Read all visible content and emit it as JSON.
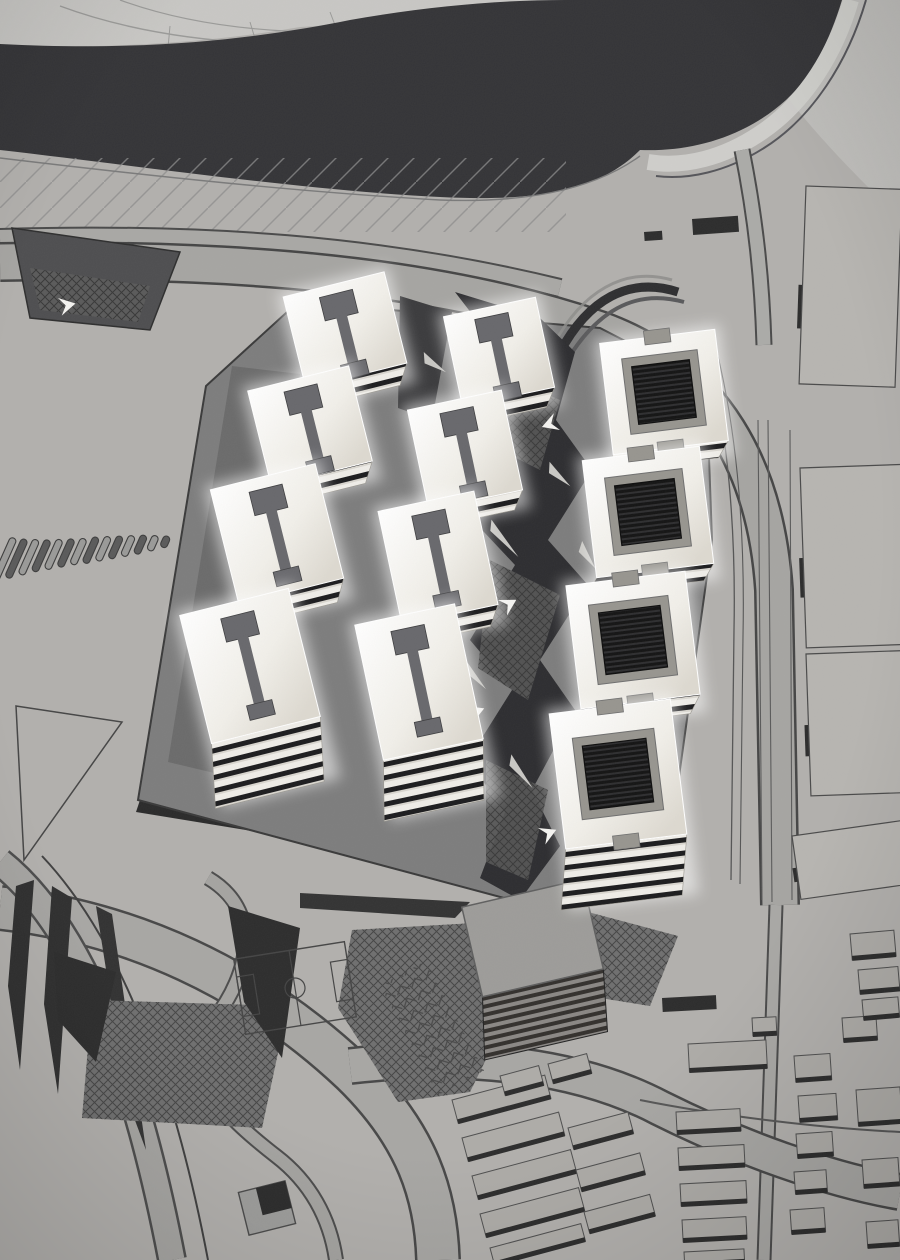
{
  "image": {
    "type": "photograph",
    "subject": "monochrome architectural scale model of a riverside masterplan",
    "description": "Cardboard site model with three rows of illuminated translucent apartment blocks on a dark podium, angular dark plaza, engraved football pitch, stacked cardboard pavilion, surrounding streets and low cardboard housing blocks, dark river across the top"
  },
  "palette": {
    "board": "#b2b0ad",
    "boardLight": "#c8c7c4",
    "river": "#343437",
    "podium": "#7d7d7d",
    "podiumInner": "#6b6b6b",
    "podiumEdge": "#3a3a3a",
    "plazaDark": "#2d2d30",
    "roofBar": "#68686c",
    "courtFrame": "#97958f",
    "cardDark": "#2c2c2c",
    "roadLight": "#a8a7a4",
    "lineDark": "#4a4a4a",
    "white": "#f4f3f0",
    "arrowGray": "#c9c8c4",
    "slabTop": "#aeaca8",
    "blockTop": "#b7b5b1"
  },
  "model": {
    "tower_rows": 3,
    "towers_total": 12,
    "courtyard_blocks": 4,
    "ibeam_blocks": 8,
    "football_pitch": 1,
    "stacked_pavilion": 1
  },
  "builder": {
    "towers": {
      "rows": [
        {
          "name": "west-row",
          "kind": "ibeam",
          "angle": -14,
          "items": [
            {
              "cx": 345,
              "cy": 330,
              "w": 104,
              "h": 94,
              "side": 20
            },
            {
              "cx": 310,
              "cy": 426,
              "w": 104,
              "h": 98,
              "side": 20
            },
            {
              "cx": 277,
              "cy": 534,
              "w": 108,
              "h": 118,
              "side": 22
            },
            {
              "cx": 250,
              "cy": 666,
              "w": 112,
              "h": 132,
              "side": 64
            }
          ]
        },
        {
          "name": "center-row",
          "kind": "ibeam",
          "angle": -12,
          "items": [
            {
              "cx": 499,
              "cy": 352,
              "w": 94,
              "h": 92,
              "side": 18
            },
            {
              "cx": 465,
              "cy": 450,
              "w": 96,
              "h": 102,
              "side": 18
            },
            {
              "cx": 438,
              "cy": 558,
              "w": 98,
              "h": 116,
              "side": 20
            },
            {
              "cx": 419,
              "cy": 682,
              "w": 102,
              "h": 138,
              "side": 60
            }
          ]
        },
        {
          "name": "east-row",
          "kind": "court",
          "angle": -7,
          "items": [
            {
              "cx": 664,
              "cy": 392,
              "w": 116,
              "h": 112,
              "side": 16
            },
            {
              "cx": 648,
              "cy": 512,
              "w": 118,
              "h": 118,
              "side": 16
            },
            {
              "cx": 633,
              "cy": 640,
              "w": 120,
              "h": 124,
              "side": 18
            },
            {
              "cx": 618,
              "cy": 774,
              "w": 122,
              "h": 136,
              "side": 60
            }
          ]
        }
      ]
    },
    "slots": {
      "startX": 4,
      "startY": 560,
      "dx": 12.4,
      "dy": -1.4,
      "rot": 24,
      "width": 7,
      "lengths": [
        48,
        42,
        38,
        34,
        32,
        30,
        28,
        28,
        26,
        24,
        22,
        20,
        16,
        12
      ]
    },
    "chevrons": [
      {
        "x": 490,
        "y": 336,
        "r": -20
      },
      {
        "x": 446,
        "y": 430,
        "r": -28
      },
      {
        "x": 498,
        "y": 600,
        "r": -30
      },
      {
        "x": 466,
        "y": 706,
        "r": -22
      },
      {
        "x": 436,
        "y": 926,
        "r": -16
      },
      {
        "x": 244,
        "y": 1050,
        "r": -38
      },
      {
        "x": 58,
        "y": 298,
        "r": -12
      },
      {
        "x": 560,
        "y": 430,
        "r": 160
      },
      {
        "x": 538,
        "y": 828,
        "r": -24
      }
    ],
    "arrows": [
      {
        "x": 494,
        "y": 518,
        "r": 58,
        "l": 46
      },
      {
        "x": 514,
        "y": 753,
        "r": 62,
        "l": 40
      },
      {
        "x": 552,
        "y": 460,
        "r": 55,
        "l": 32
      },
      {
        "x": 468,
        "y": 658,
        "r": 60,
        "l": 36
      },
      {
        "x": 426,
        "y": 350,
        "r": 48,
        "l": 30
      },
      {
        "x": 585,
        "y": 540,
        "r": 70,
        "l": 30
      }
    ],
    "bigBlocks": [
      {
        "x": 806,
        "y": 186,
        "w": 96,
        "h": 198,
        "a": 2
      },
      {
        "x": 800,
        "y": 468,
        "w": 102,
        "h": 180,
        "a": -2
      },
      {
        "x": 806,
        "y": 654,
        "w": 96,
        "h": 142,
        "a": -2
      },
      {
        "x": 792,
        "y": 836,
        "w": 110,
        "h": 64,
        "a": -8
      }
    ],
    "darkSlabs": [
      {
        "x": 692,
        "y": 219,
        "w": 46,
        "h": 16,
        "a": -4
      },
      {
        "x": 644,
        "y": 232,
        "w": 18,
        "h": 9,
        "a": -4
      },
      {
        "x": 662,
        "y": 998,
        "w": 54,
        "h": 14,
        "a": -3
      }
    ],
    "slabs": [
      {
        "x": 676,
        "y": 1112,
        "w": 64,
        "h": 22,
        "a": -3
      },
      {
        "x": 678,
        "y": 1148,
        "w": 66,
        "h": 22,
        "a": -3
      },
      {
        "x": 680,
        "y": 1184,
        "w": 66,
        "h": 22,
        "a": -3
      },
      {
        "x": 682,
        "y": 1220,
        "w": 64,
        "h": 22,
        "a": -3
      },
      {
        "x": 684,
        "y": 1252,
        "w": 60,
        "h": 14,
        "a": -3
      },
      {
        "x": 688,
        "y": 1044,
        "w": 78,
        "h": 28,
        "a": -3
      },
      {
        "x": 752,
        "y": 1018,
        "w": 24,
        "h": 18,
        "a": -3
      },
      {
        "x": 794,
        "y": 1056,
        "w": 36,
        "h": 26,
        "a": -4
      },
      {
        "x": 798,
        "y": 1096,
        "w": 38,
        "h": 26,
        "a": -4
      },
      {
        "x": 796,
        "y": 1134,
        "w": 36,
        "h": 24,
        "a": -4
      },
      {
        "x": 794,
        "y": 1172,
        "w": 32,
        "h": 22,
        "a": -4
      },
      {
        "x": 790,
        "y": 1210,
        "w": 34,
        "h": 24,
        "a": -4
      },
      {
        "x": 856,
        "y": 1090,
        "w": 44,
        "h": 36,
        "a": -4
      },
      {
        "x": 862,
        "y": 1160,
        "w": 36,
        "h": 28,
        "a": -4
      },
      {
        "x": 866,
        "y": 1222,
        "w": 32,
        "h": 26,
        "a": -4
      },
      {
        "x": 842,
        "y": 1018,
        "w": 34,
        "h": 24,
        "a": -4
      },
      {
        "x": 452,
        "y": 1100,
        "w": 96,
        "h": 24,
        "a": -15
      },
      {
        "x": 462,
        "y": 1138,
        "w": 100,
        "h": 24,
        "a": -15
      },
      {
        "x": 472,
        "y": 1176,
        "w": 102,
        "h": 24,
        "a": -15
      },
      {
        "x": 480,
        "y": 1214,
        "w": 102,
        "h": 24,
        "a": -15
      },
      {
        "x": 490,
        "y": 1248,
        "w": 94,
        "h": 18,
        "a": -15
      },
      {
        "x": 500,
        "y": 1076,
        "w": 40,
        "h": 20,
        "a": -15
      },
      {
        "x": 548,
        "y": 1064,
        "w": 40,
        "h": 20,
        "a": -15
      },
      {
        "x": 568,
        "y": 1128,
        "w": 62,
        "h": 22,
        "a": -15
      },
      {
        "x": 576,
        "y": 1170,
        "w": 66,
        "h": 22,
        "a": -15
      },
      {
        "x": 584,
        "y": 1212,
        "w": 68,
        "h": 22,
        "a": -15
      },
      {
        "x": 850,
        "y": 934,
        "w": 44,
        "h": 26,
        "a": -5
      },
      {
        "x": 858,
        "y": 970,
        "w": 40,
        "h": 24,
        "a": -5
      },
      {
        "x": 862,
        "y": 1000,
        "w": 36,
        "h": 20,
        "a": -5
      }
    ]
  }
}
